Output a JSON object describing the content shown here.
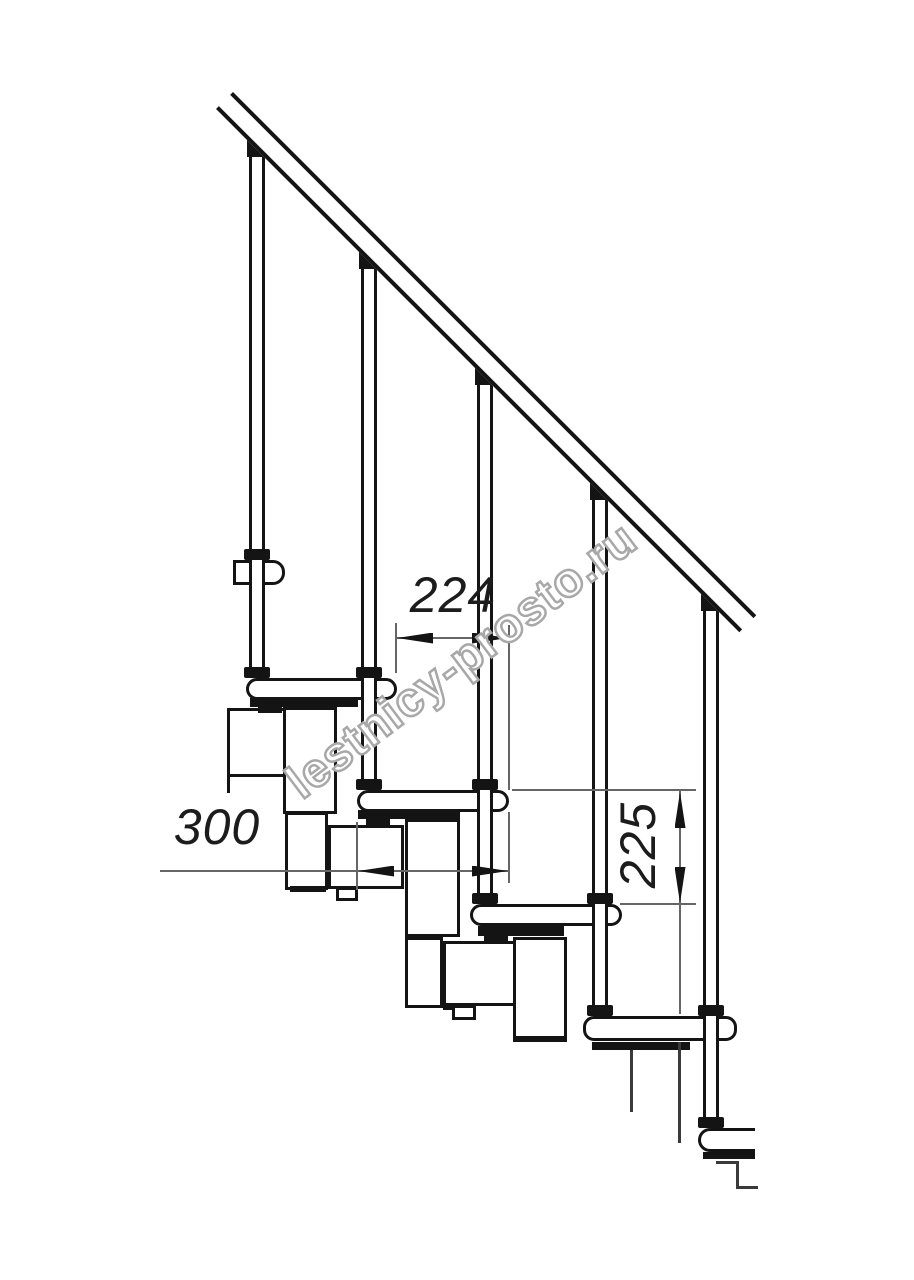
{
  "page": {
    "background": "#ffffff",
    "ink": "#141414",
    "thin_line": "#666666"
  },
  "watermark": {
    "text": "lestnicy-prosto.ru",
    "fill": "#ffffff",
    "outline": "#a8a8a8"
  },
  "drawing": {
    "type": "staircase-side-elevation",
    "dimensions": {
      "going": {
        "label": "224",
        "orientation": "horizontal"
      },
      "tread_depth": {
        "label": "300",
        "orientation": "horizontal"
      },
      "rise": {
        "label": "225",
        "orientation": "vertical"
      }
    }
  }
}
